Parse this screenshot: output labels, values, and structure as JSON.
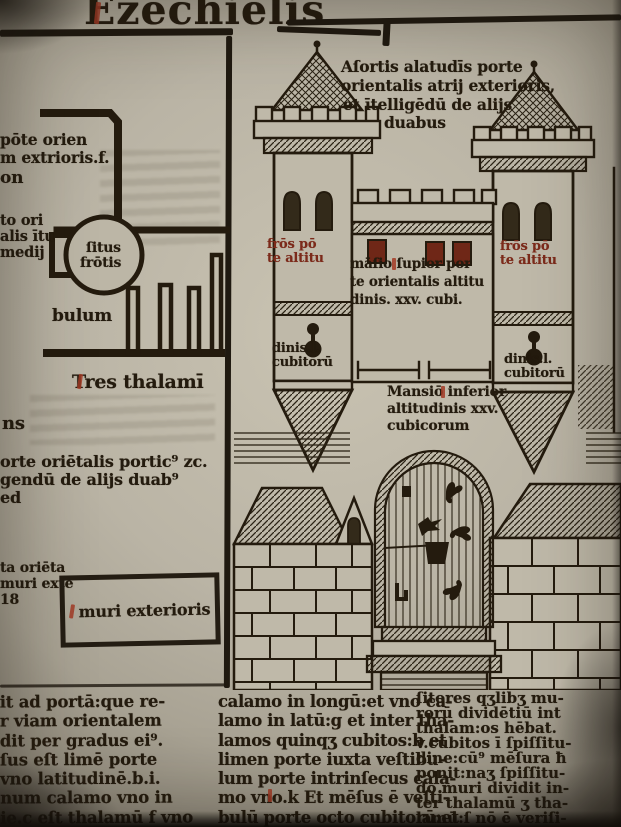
{
  "page": {
    "title": "Ezechielis"
  },
  "colors": {
    "ink": "#241b0e",
    "red": "#a23a24",
    "red_dark": "#7c2a1a",
    "paper": "#bfb9a9"
  },
  "left_column": {
    "fragments_top": [
      "pōte orien",
      "m extrioris.f.",
      "on"
    ],
    "fragments_mid": [
      "to ori",
      "alis ītu",
      "medij"
    ],
    "circle_label_lines": [
      "ſitus",
      "frōtis"
    ],
    "vestibulum_fragment": "bulum",
    "comb_caption": "Tres thalamī",
    "fragment_ns": "ns",
    "paragraph_lines": [
      "orte oriētalis portic⁹ zc.",
      "gendū de alijs duab⁹",
      "ed"
    ],
    "box_side_fragments": [
      "ta oriēta",
      "muri exte",
      "18"
    ],
    "box_label": "muri exterioris"
  },
  "woodcut": {
    "caption_lines": [
      "Aſortis alatudīs porte",
      "orientalis atrij exterioris,",
      "et ītelligēdū de alijs",
      "duabus"
    ],
    "left_tower_label_lines": [
      "frōs pō",
      "te altitu"
    ],
    "right_tower_label_lines": [
      "frōs pō",
      "te altitu"
    ],
    "left_tower_height_lines": [
      "dinis.l.",
      "cubitorū"
    ],
    "right_tower_height_lines": [
      "dinis.l.",
      "cubitorū"
    ],
    "upper_mansion_lines": [
      "māſio ſupior por",
      "te orientalis altitu",
      "dinis. xxv. cubi."
    ],
    "lower_mansion_lines": [
      "Mansiō inferior",
      "altitudinis xxv.",
      "cubicorum"
    ]
  },
  "bottom_text": {
    "column1_lines": [
      "it ad portā:que re-",
      "r viam orientalem",
      "dit per gradus ei⁹.",
      "ſus eſt limē porte",
      "vno latitudinē.b.i.",
      "num calamo vno in",
      "ie.c eſt thalamū f vno"
    ],
    "column2_lines": [
      "calamo in longū:et vno ca-",
      "lamo in latū:g et inter tha-",
      "lamos quinqʒ cubitos:b et",
      "limen porte iuxta veſtibu-",
      "lum porte intrinſecus cala-",
      "mo vno.k Et mēſus ē veſti-",
      "bulū porte octo cubitorū:et"
    ],
    "column3_lines": [
      "ſitores qʒlibʒ mu-",
      "rorū dividētiū int",
      "thalam:os hēbat.",
      "v.cubitos ī ſpiſſitu-",
      "dine:cū⁹ mēſura ħ",
      "ponit:naʒ ſpiſſitu-",
      "do muri dividit in-",
      "ter thalamū ʒ tha-",
      "lamū:ſ nō ē veriſi-"
    ]
  }
}
